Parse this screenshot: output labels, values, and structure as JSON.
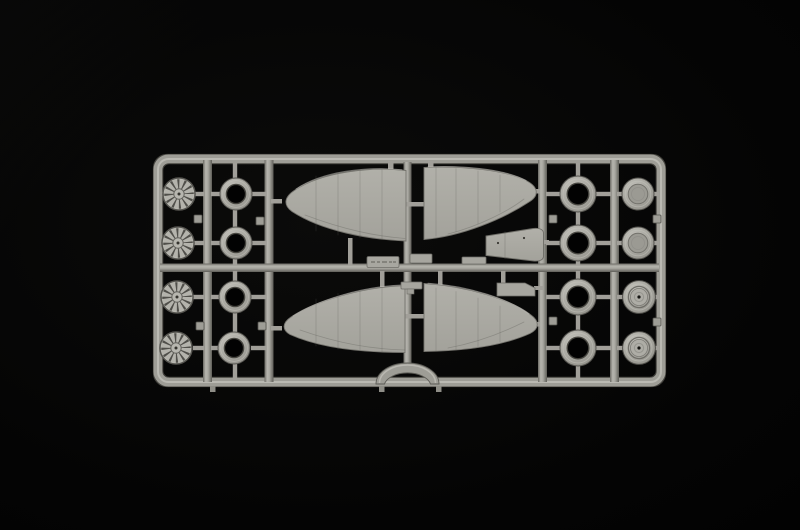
{
  "scene": {
    "subject": "plastic model kit parts sprue photographed on a black background",
    "kit_scale_hint": "aircraft model sprue",
    "background": "black studio backdrop",
    "sprue_material": "light grey polystyrene"
  },
  "colors": {
    "bg": "#020202",
    "plastic": "#a5a49d",
    "plastic-light": "#bcbbb4",
    "plastic-mid": "#9e9d96",
    "plastic-dark": "#6b6a64",
    "plastic-deep": "#504f4a",
    "highlight": "#c6c5be",
    "hole": "#020202"
  },
  "sprue": {
    "frame": {
      "shape": "rounded rectangle runner frame",
      "internal_rails": 5,
      "center_cross_bar": 1,
      "bottom_arch": "semicircular arch at bottom center",
      "ejector_nubs": 8,
      "feet_tabs": 3
    },
    "parts": [
      {
        "name": "radial-engine-front",
        "count": 4,
        "location": "left column, star shaped cylinder faces"
      },
      {
        "name": "cowl-ring-small",
        "count": 4,
        "location": "second column, open rings"
      },
      {
        "name": "upper-wing-half",
        "count": 2,
        "location": "center top, tips pointing outward"
      },
      {
        "name": "lower-wing-half",
        "count": 2,
        "location": "center bottom, tips pointing outward"
      },
      {
        "name": "cowling-panel",
        "count": 1,
        "location": "center right, trapezoid with rivet dots"
      },
      {
        "name": "small-flat-part",
        "count": 4,
        "location": "around center cross bar"
      },
      {
        "name": "embossed-mold-tag",
        "count": 1,
        "legible": false,
        "location": "on center cross bar, raised illegible marking"
      },
      {
        "name": "cowl-ring-large",
        "count": 4,
        "location": "right inner column, open rings"
      },
      {
        "name": "wheel-hub-disc",
        "count": 2,
        "location": "right outer column, top two smooth discs"
      },
      {
        "name": "main-wheel",
        "count": 2,
        "location": "right outer column, bottom two with hub hole"
      }
    ]
  }
}
